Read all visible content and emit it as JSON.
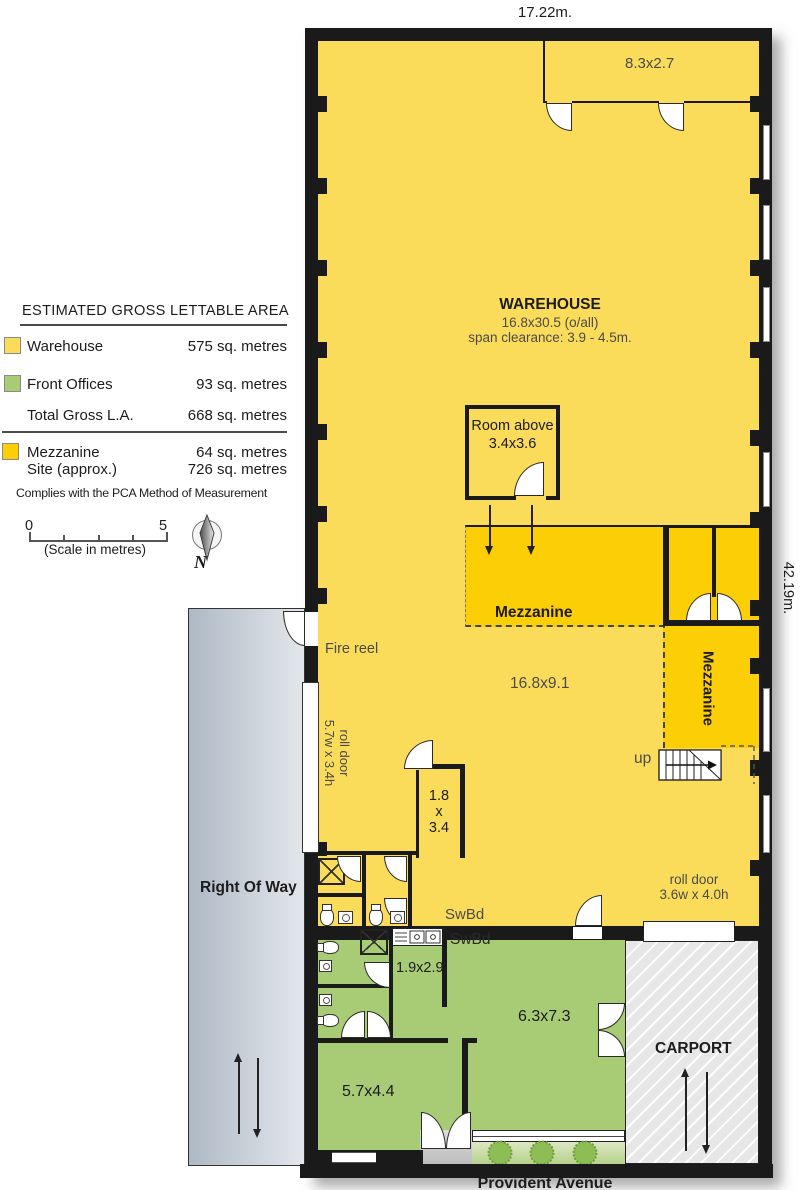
{
  "colors": {
    "warehouse": "#fbdc5a",
    "mezzanine": "#fcce06",
    "offices": "#a8cc75",
    "wall": "#1a1a1a",
    "carport": "#e7e7e7"
  },
  "legend": {
    "title": "ESTIMATED GROSS LETTABLE AREA",
    "rows": [
      {
        "label": "Warehouse",
        "value": "575 sq. metres"
      },
      {
        "label": "Front Offices",
        "value": "93 sq. metres"
      },
      {
        "label": "Total Gross L.A.",
        "value": "668 sq. metres"
      },
      {
        "label": "Mezzanine",
        "value": "64 sq. metres"
      },
      {
        "label": "Site (approx.)",
        "value": "726 sq. metres"
      }
    ],
    "compliance": "Complies with the PCA Method of Measurement",
    "scale": {
      "zero": "0",
      "five": "5",
      "caption": "(Scale in metres)"
    },
    "north": "N"
  },
  "dimensions": {
    "top": "17.22m.",
    "right": "42.19m."
  },
  "warehouse": {
    "name": "WAREHOUSE",
    "size": "16.8x30.5 (o/all)",
    "clearance": "span clearance: 3.9 - 4.5m.",
    "floor_size": "16.8x9.1"
  },
  "rooms": {
    "store_top": "8.3x2.7",
    "room_above_1": "Room above",
    "room_above_2": "3.4x3.6",
    "small_1": "1.8",
    "small_2": "x",
    "small_3": "3.4",
    "kitchen": "1.9x2.9",
    "office_a": "6.3x7.3",
    "office_b": "5.7x4.4"
  },
  "mezzanine": {
    "label_h": "Mezzanine",
    "label_v": "Mezzanine",
    "up": "up"
  },
  "labels": {
    "fire_reel": "Fire reel",
    "roll_door_left_1": "roll door",
    "roll_door_left_2": "5.7w x 3.4h",
    "roll_door_right_1": "roll door",
    "roll_door_right_2": "3.6w x 4.0h",
    "swbd_a": "SwBd",
    "swbd_b": "SwBd",
    "right_of_way": "Right Of Way",
    "carport": "CARPORT",
    "street": "Provident Avenue"
  }
}
